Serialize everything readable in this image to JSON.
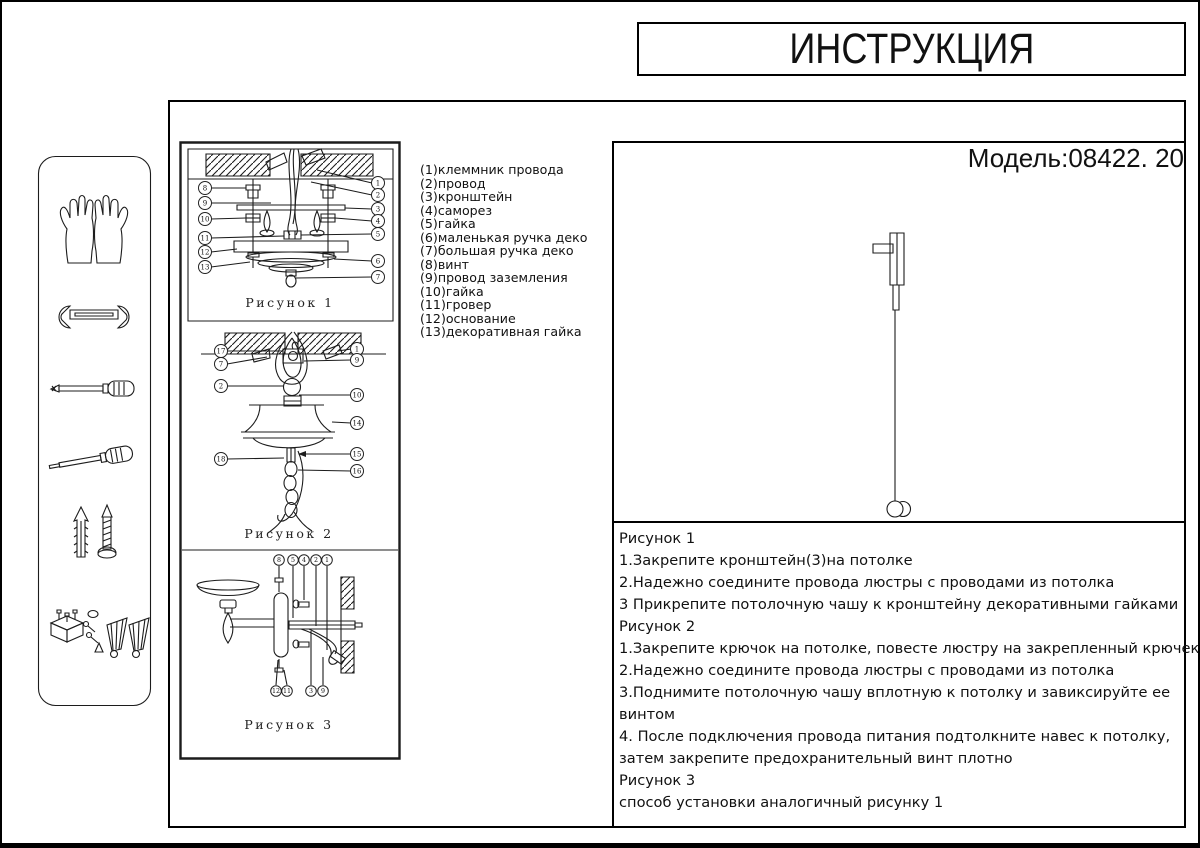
{
  "page": {
    "title": "ИНСТРУКЦИЯ",
    "model": "Модель:08422. 20"
  },
  "colors": {
    "ink": "#1c1c1c",
    "paper": "#ffffff"
  },
  "parts": [
    "(1)клеммник провода",
    "(2)провод",
    "(3)кронштейн",
    "(4)саморез",
    "(5)гайка",
    "(6)маленькая ручка деко",
    "(7)большая ручка деко",
    "(8)винт",
    "(9)провод заземления",
    "(10)гайка",
    "(11)гровер",
    "(12)основание",
    "(13)декоративная гайка"
  ],
  "figures": {
    "fig1": {
      "caption": "Рисунок 1",
      "left": [
        "8",
        "9",
        "10",
        "11",
        "12",
        "13"
      ],
      "right": [
        "1",
        "2",
        "3",
        "4",
        "5",
        "6",
        "7"
      ]
    },
    "fig2": {
      "caption": "Рисунок 2",
      "left": [
        "17",
        "7",
        "2",
        "18"
      ],
      "right": [
        "1",
        "9",
        "10",
        "14",
        "15",
        "16"
      ]
    },
    "fig3": {
      "caption": "Рисунок 3",
      "top": [
        "8",
        "5",
        "4",
        "2",
        "1"
      ],
      "bottom": [
        "12",
        "11",
        "3",
        "9"
      ]
    }
  },
  "instructions": {
    "lines": [
      "Рисунок 1",
      "1.Закрепите кронштейн(3)на потолке",
      "2.Надежно соедините провода люстры с проводами из потолка",
      "3 Прикрепите потолочную чашу к кронштейну декоративными гайками",
      "Рисунок 2",
      "1.Закрепите крючок на потолке, повесте люстру на закрепленный крючек",
      "2.Надежно соедините провода люстры с проводами из потолка",
      "3.Поднимите потолочную чашу вплотную к потолку и завиксируйте ее",
      "винтом",
      "4.  После подключения провода питания подтолкните навес к потолку,",
      "затем закрепите предохранительный винт плотно",
      "Рисунок 3",
      "способ установки аналогичный рисунку 1"
    ]
  },
  "tools": {
    "icons": [
      "gloves-icon",
      "wrench-icon",
      "phillips-screwdriver-icon",
      "flathead-screwdriver-icon",
      "wall-anchor-screw-icon",
      "fasteners-kit-icon"
    ]
  }
}
